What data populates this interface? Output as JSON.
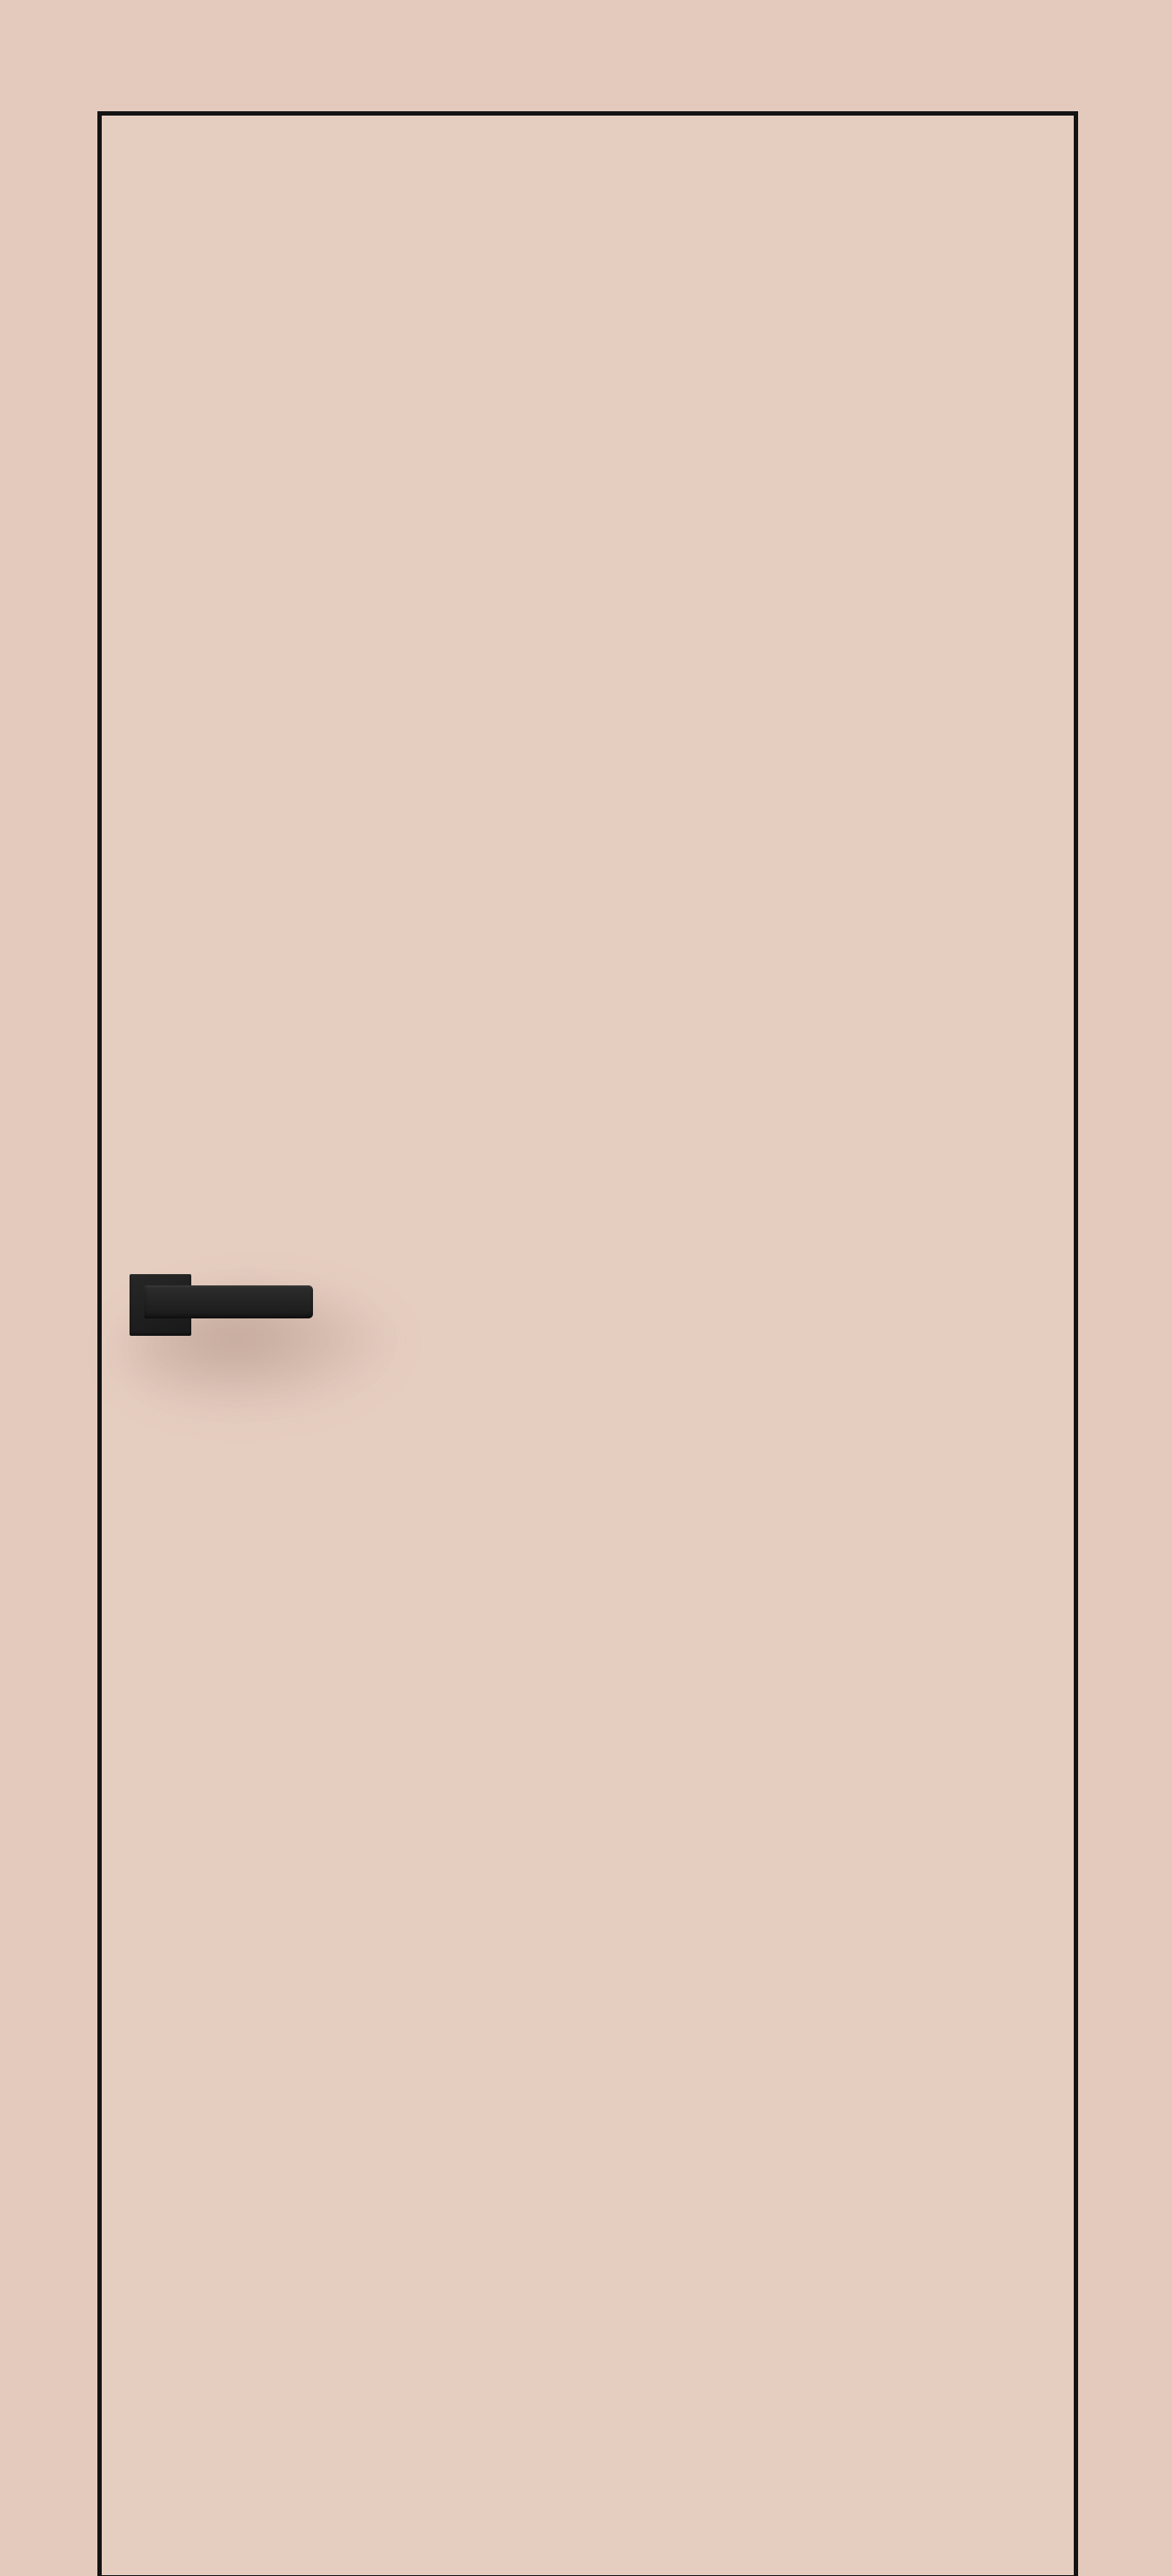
{
  "scene": {
    "subject": "interior-flush-door-product-photo",
    "elements": {
      "door": "door-panel",
      "handle": "door-handle"
    }
  },
  "colors": {
    "backdrop": "#e3cabd",
    "door_fill": "#e5cdc0",
    "outline": "#131313",
    "handle_plate": "#222222",
    "handle_lever": "#262626",
    "shadow_core": "rgba(141,108,93,0.75)",
    "shadow_fade": "rgba(141,108,93,0)"
  },
  "gradients": {
    "plate": "linear-gradient(160deg, #272727 0%, #1f1f1f 55%, #191919 100%)",
    "lever": "linear-gradient(180deg, #2d2d2d 0%, #242424 45%, #1b1b1b 100%)"
  }
}
